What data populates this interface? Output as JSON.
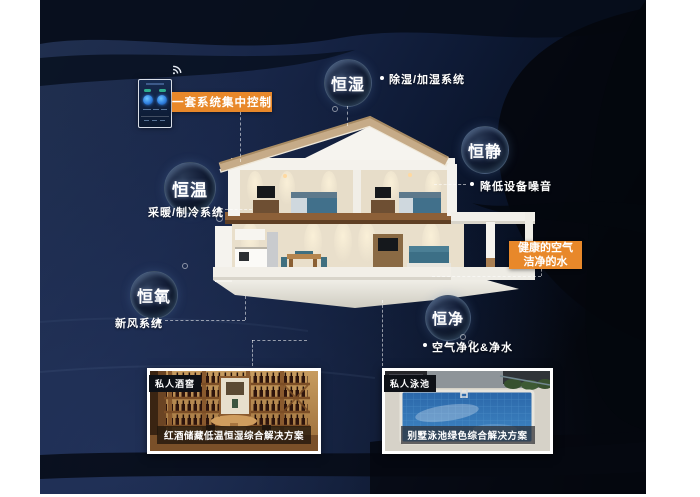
{
  "scene": {
    "type": "smart-home villa infographic"
  },
  "colors": {
    "accent_orange": "#E8882A",
    "background_navy": "#1B2A4E",
    "wave_dark": "#05090F",
    "text_white": "#FFFFFF"
  },
  "control_panel": {
    "label": "一套系统集中控制",
    "wifi_icon": "wifi-signal",
    "device_icon": "smart-home-controller"
  },
  "features": [
    {
      "label": "恒湿",
      "note": "除湿/加湿系统"
    },
    {
      "label": "恒静",
      "note": "降低设备噪音"
    },
    {
      "label": "恒温",
      "note": "采暖/制冷系统"
    },
    {
      "label": "恒氧",
      "note": "新风系统"
    },
    {
      "label": "恒净",
      "note": "空气净化&净水"
    }
  ],
  "highlight": {
    "line1": "健康的空气",
    "line2": "洁净的水"
  },
  "cases": [
    {
      "tag": "私人酒窖",
      "caption": "红酒储藏低温恒湿综合解决方案"
    },
    {
      "tag": "私人泳池",
      "caption": "别墅泳池绿色综合解决方案"
    }
  ]
}
